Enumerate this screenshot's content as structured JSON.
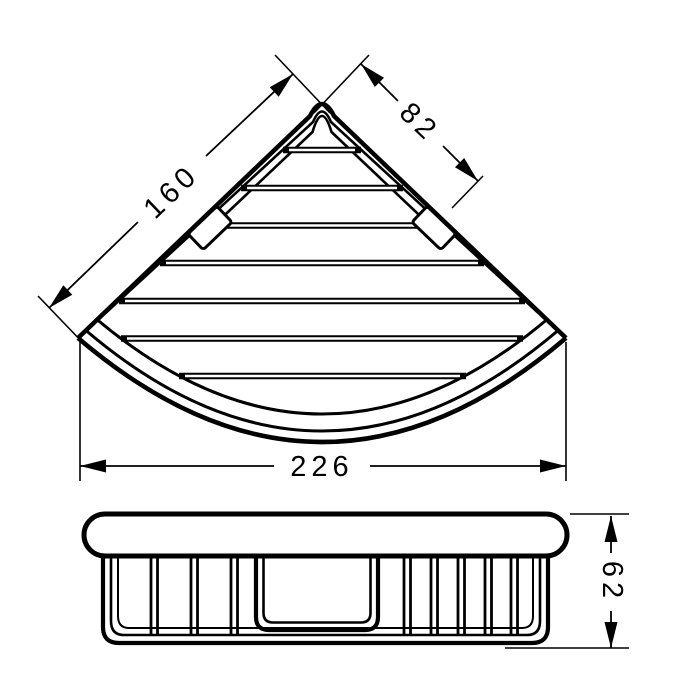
{
  "drawing": {
    "type": "technical-dimension-drawing",
    "colors": {
      "line": "#000000",
      "background": "#ffffff"
    },
    "dimensions": {
      "left_edge": "160",
      "right_edge_to_clip": "82",
      "overall_width": "226",
      "overall_height": "62"
    }
  }
}
